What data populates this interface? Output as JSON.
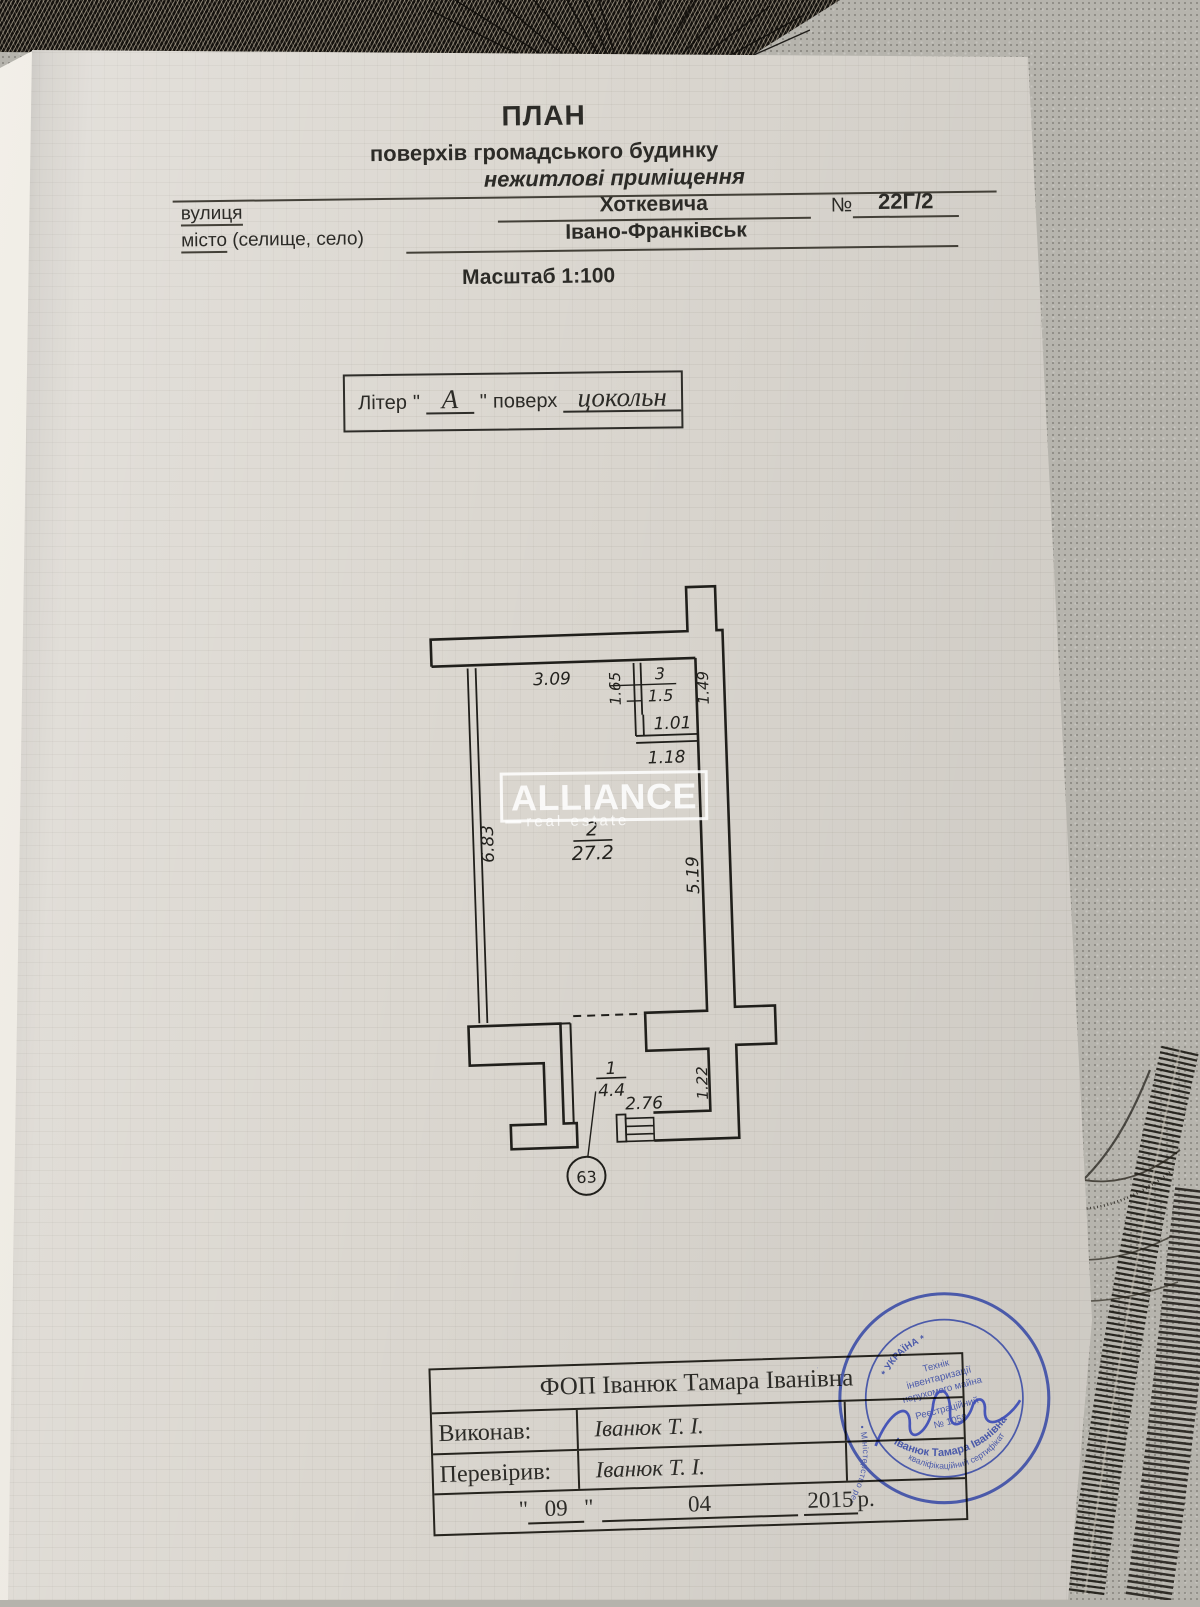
{
  "header": {
    "title": "ПЛАН",
    "subtitle1": "поверхів громадського будинку",
    "subtitle2": "нежитлові приміщення",
    "street_label": "вулиця",
    "street_value": "Хоткевича",
    "number_label": "№",
    "number_value": "22Г/2",
    "city_label_word": "місто",
    "city_label_rest": " (селище, село)",
    "city_value": "Івано-Франківськ",
    "scale": "Масштаб 1:100"
  },
  "liter": {
    "label": "Літер",
    "quote_open": "\"",
    "value": "А",
    "quote_close": "\"",
    "floor_label": "поверх",
    "floor_value": "цокольн"
  },
  "plan": {
    "dims": {
      "top": "3.09",
      "partition": "1.65",
      "room3_right": "1.49",
      "room3_width": "1.01",
      "below_room3": "1.18",
      "left": "6.83",
      "right": "5.19",
      "door": "2.76",
      "notch": "1.22"
    },
    "rooms": {
      "r3_num": "3",
      "r3_area": "1.5",
      "r2_num": "2",
      "r2_area": "27.2",
      "r1_num": "1",
      "r1_area": "4.4"
    },
    "marker": "63"
  },
  "watermark": {
    "brand": "ALLIANCE",
    "tagline": "real estate"
  },
  "table": {
    "company": "ФОП Іванюк Тамара Іванівна",
    "rows": [
      {
        "label": "Виконав:",
        "value": "Іванюк Т. І."
      },
      {
        "label": "Перевірив:",
        "value": "Іванюк Т. І."
      }
    ],
    "date": {
      "q1": "\"",
      "day": "09",
      "q2": "\"",
      "month": "04",
      "year": "2015",
      "year_suffix": "р."
    }
  },
  "stamp": {
    "ring_text": "• Міністерство регіонального розвитку, будівництва та житлово-комунального господарства • свідоцтво № 002155",
    "country": "* УКРАЇНА *",
    "line1": "Технік",
    "line2": "інвентаризації",
    "line3": "нерухомого майна",
    "line4": "Реєстраційний",
    "line5": "№ 1058",
    "name": "Іванюк Тамара Іванівна",
    "cert": "кваліфікаційний сертифікат",
    "color": "#3c4da6"
  }
}
